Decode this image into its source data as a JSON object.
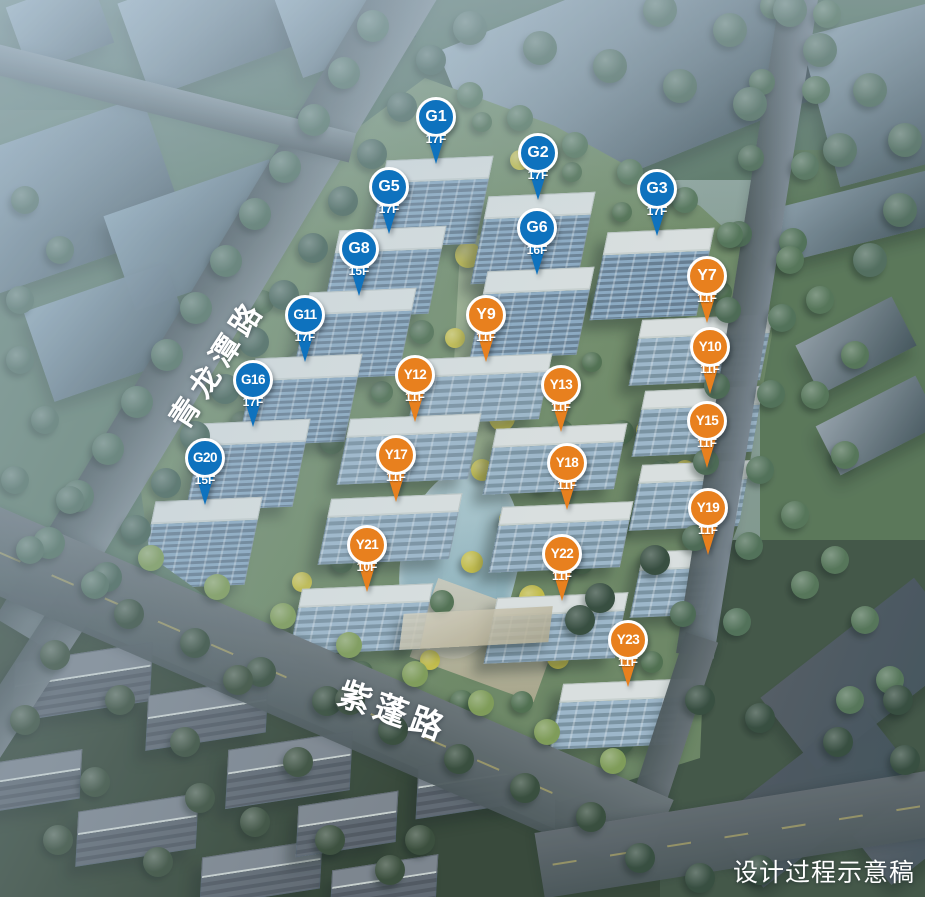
{
  "palette": {
    "pin_blue": "#0E72BE",
    "pin_orange": "#E8801E",
    "pin_text": "#FFFFFF"
  },
  "pins": [
    {
      "id": "G1",
      "floors": "17F",
      "color": "blue",
      "x": 436,
      "y": 164
    },
    {
      "id": "G2",
      "floors": "17F",
      "color": "blue",
      "x": 538,
      "y": 200
    },
    {
      "id": "G3",
      "floors": "17F",
      "color": "blue",
      "x": 657,
      "y": 236
    },
    {
      "id": "G5",
      "floors": "17F",
      "color": "blue",
      "x": 389,
      "y": 234
    },
    {
      "id": "G6",
      "floors": "16F",
      "color": "blue",
      "x": 537,
      "y": 275
    },
    {
      "id": "G8",
      "floors": "15F",
      "color": "blue",
      "x": 359,
      "y": 296
    },
    {
      "id": "Y7",
      "floors": "11F",
      "color": "orange",
      "x": 707,
      "y": 323
    },
    {
      "id": "G11",
      "floors": "17F",
      "color": "blue",
      "x": 305,
      "y": 362
    },
    {
      "id": "Y9",
      "floors": "11F",
      "color": "orange",
      "x": 486,
      "y": 362
    },
    {
      "id": "Y10",
      "floors": "11F",
      "color": "orange",
      "x": 710,
      "y": 394
    },
    {
      "id": "G16",
      "floors": "17F",
      "color": "blue",
      "x": 253,
      "y": 427
    },
    {
      "id": "Y12",
      "floors": "11F",
      "color": "orange",
      "x": 415,
      "y": 422
    },
    {
      "id": "Y13",
      "floors": "11F",
      "color": "orange",
      "x": 561,
      "y": 432
    },
    {
      "id": "Y15",
      "floors": "11F",
      "color": "orange",
      "x": 707,
      "y": 468
    },
    {
      "id": "G20",
      "floors": "15F",
      "color": "blue",
      "x": 205,
      "y": 505
    },
    {
      "id": "Y17",
      "floors": "11F",
      "color": "orange",
      "x": 396,
      "y": 502
    },
    {
      "id": "Y18",
      "floors": "11F",
      "color": "orange",
      "x": 567,
      "y": 510
    },
    {
      "id": "Y19",
      "floors": "11F",
      "color": "orange",
      "x": 708,
      "y": 555
    },
    {
      "id": "Y21",
      "floors": "10F",
      "color": "orange",
      "x": 367,
      "y": 592
    },
    {
      "id": "Y22",
      "floors": "11F",
      "color": "orange",
      "x": 562,
      "y": 601
    },
    {
      "id": "Y23",
      "floors": "11F",
      "color": "orange",
      "x": 628,
      "y": 687
    }
  ],
  "roads": [
    {
      "name": "青龙潭路"
    },
    {
      "name": "紫蓬路"
    }
  ],
  "caption": "设计过程示意稿"
}
